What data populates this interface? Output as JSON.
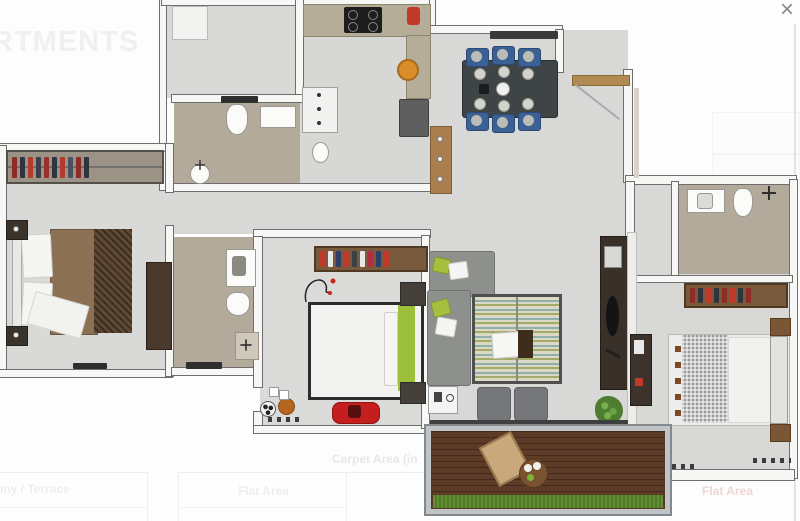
{
  "lightbox": {
    "watermark": "RTMENTS",
    "close_label": "×"
  },
  "page_table": {
    "title": "Carpet Area (in",
    "columns": [
      "ony / Terrace",
      "Flat Area"
    ],
    "right_column": "Flat Area"
  },
  "palette": {
    "floor_gray": "#d9d9d7",
    "floor_tan": "#b3aa9c",
    "deck_wood": "#5d3b26",
    "grass_green": "#4e7c20",
    "dining_chair_blue": "#3a6094",
    "bed_accent_green": "#9cc03c",
    "toy_car_red": "#c41e1e",
    "wood_brown": "#a97f4f",
    "dark_furniture": "#39302a",
    "right_flat_label_pink": "#edd6d6"
  },
  "wardrobes": {
    "master": [
      "#8e2b25",
      "#2e3440",
      "#b23b2e",
      "#3a3f4a",
      "#9c2f28",
      "#2e3440",
      "#b23b2e",
      "#4a5160",
      "#8e2b25",
      "#30343c"
    ],
    "kids": [
      "#c03a2e",
      "#e8e8e8",
      "#2e3e66",
      "#c03a2e",
      "#384048",
      "#e8e8e8",
      "#b03040",
      "#2e3e66",
      "#c03a2e"
    ],
    "right": [
      "#8e2b25",
      "#30343c",
      "#c0392b",
      "#30343c",
      "#8e2b25",
      "#c0392b",
      "#30343c",
      "#8e2b25"
    ]
  }
}
